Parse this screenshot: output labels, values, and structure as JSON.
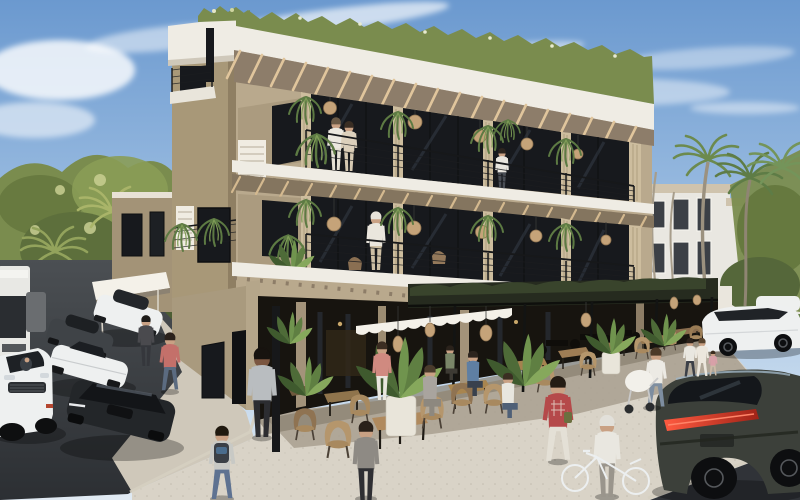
{
  "image": {
    "type": "architectural rendering",
    "description": "Sunny 3D visualization of a modern tropical three-storey aparthotel on a street corner: wood-slat balcony bays with black cable railings, hanging ferns and rattan ball pendant lamps, rooftop greenery over a white fascia with timber pergola rafters, and a ground-floor cafe terrace with wooden tables, wicker chairs and potted plants. Pedestrians fill the terrazzo plaza; cars queue on the left street; a dark SUV and white sedan park at right before a white apartment building, palms and lawn.",
    "time_of_day": "daytime, clear blue sky with wispy clouds"
  },
  "colors": {
    "sky_top": "#6b99cf",
    "sky_mid": "#a9c7e6",
    "sky_horizon": "#e0eaf3",
    "cloud": "#ffffff",
    "foliage_dark": "#55663a",
    "foliage_mid": "#7a8c4e",
    "foliage_light": "#aab86a",
    "foliage_pale": "#ced29b",
    "palm_green": "#5e7c46",
    "palm_trunk": "#9b917f",
    "bldg_white": "#efece4",
    "bldg_beige": "#b9a98d",
    "bldg_beige_shadow": "#a09076",
    "slat_wood": "#cdbd9e",
    "rafter_wood": "#e0c59c",
    "soffit": "#8d7d6a",
    "glass_dark": "#17191d",
    "frame_black": "#141414",
    "pergola_dark": "#262b1f",
    "pergola_moss": "#39442c",
    "awning_white": "#f4f1e9",
    "rattan": "#c5a379",
    "terrazzo": "#d9d3c7",
    "terrazzo_shade": "#a89f8f",
    "asphalt": "#45484c",
    "asphalt_dark": "#303338",
    "bg_building_white": "#e9e7e1",
    "bg_window": "#3c4046",
    "lawn": "#7e9b55",
    "car_white": "#eef0f0",
    "car_black": "#232629",
    "suv_dark": "#3c403a",
    "tail_red": "#d6402e",
    "skin": "#c9a184",
    "skin_dark": "#7b5640"
  },
  "building": {
    "storeys": 3,
    "balcony_bays_per_floor": 4,
    "features": [
      "rooftop greenery",
      "white fascia bands",
      "timber pergola rafters",
      "wood-slat balcony piers",
      "black cable railings",
      "hanging ferns",
      "rattan ball pendant lights",
      "white breeze-block panels",
      "corner stair tower",
      "ground-floor cafe with dark trellis canopy",
      "white scalloped awning",
      "woven lanterns"
    ]
  },
  "cafe_terrace": {
    "floor": "light speckled terrazzo plaza",
    "tables": 9,
    "chair_style": "round-back wicker/rattan",
    "planters": 6
  },
  "background": {
    "left": "dense tropical tree canopy",
    "right": [
      "white apartment building with dark windows",
      "fan palms",
      "green lawn",
      "arched retail wall with lanterns"
    ]
  },
  "vehicles": [
    {
      "label": "white bus",
      "position": "far left edge"
    },
    {
      "label": "white hatchback",
      "position": "left street, rear of queue"
    },
    {
      "label": "dark grey sedan",
      "position": "left street"
    },
    {
      "label": "white sports car",
      "position": "left street"
    },
    {
      "label": "black sports coupe",
      "position": "left street, foreground"
    },
    {
      "label": "white luxury SUV with driver",
      "position": "bottom left corner"
    },
    {
      "label": "white sedan",
      "position": "right, parked beside lawn"
    },
    {
      "label": "second white car",
      "position": "far right, behind sedan"
    },
    {
      "label": "dark green-grey SUV with red light bar",
      "position": "bottom right"
    },
    {
      "label": "white bicycle",
      "position": "bottom centre"
    }
  ],
  "people": [
    {
      "label": "couple in white robes",
      "location": "top-floor balcony, first bay"
    },
    {
      "label": "man standing",
      "location": "top-floor balcony, third bay"
    },
    {
      "label": "woman in white with cap",
      "location": "second-floor balcony"
    },
    {
      "label": "man in red shirt with shoulder bag",
      "location": "crossing left street"
    },
    {
      "label": "man in dark cap",
      "location": "beside parked cars"
    },
    {
      "label": "man in grey tee on phone",
      "location": "corner sidewalk"
    },
    {
      "label": "man with backpack walking away",
      "location": "foreground sidewalk"
    },
    {
      "label": "woman in dark outfit on phone",
      "location": "terrace foreground"
    },
    {
      "label": "person in salmon shirt",
      "location": "cafe storefront"
    },
    {
      "label": "seated woman in grey",
      "location": "foreground table"
    },
    {
      "label": "seated man in blue shirt",
      "location": "middle table"
    },
    {
      "label": "seated man in white tee",
      "location": "right table"
    },
    {
      "label": "seated man in green shirt",
      "location": "under canopy"
    },
    {
      "label": "boy in plaid shirt",
      "location": "walking across terrace"
    },
    {
      "label": "elderly man wheeling white bicycle",
      "location": "bottom centre"
    },
    {
      "label": "woman pushing white pram",
      "location": "right of terrace"
    },
    {
      "label": "family of three",
      "location": "walking at right"
    }
  ]
}
